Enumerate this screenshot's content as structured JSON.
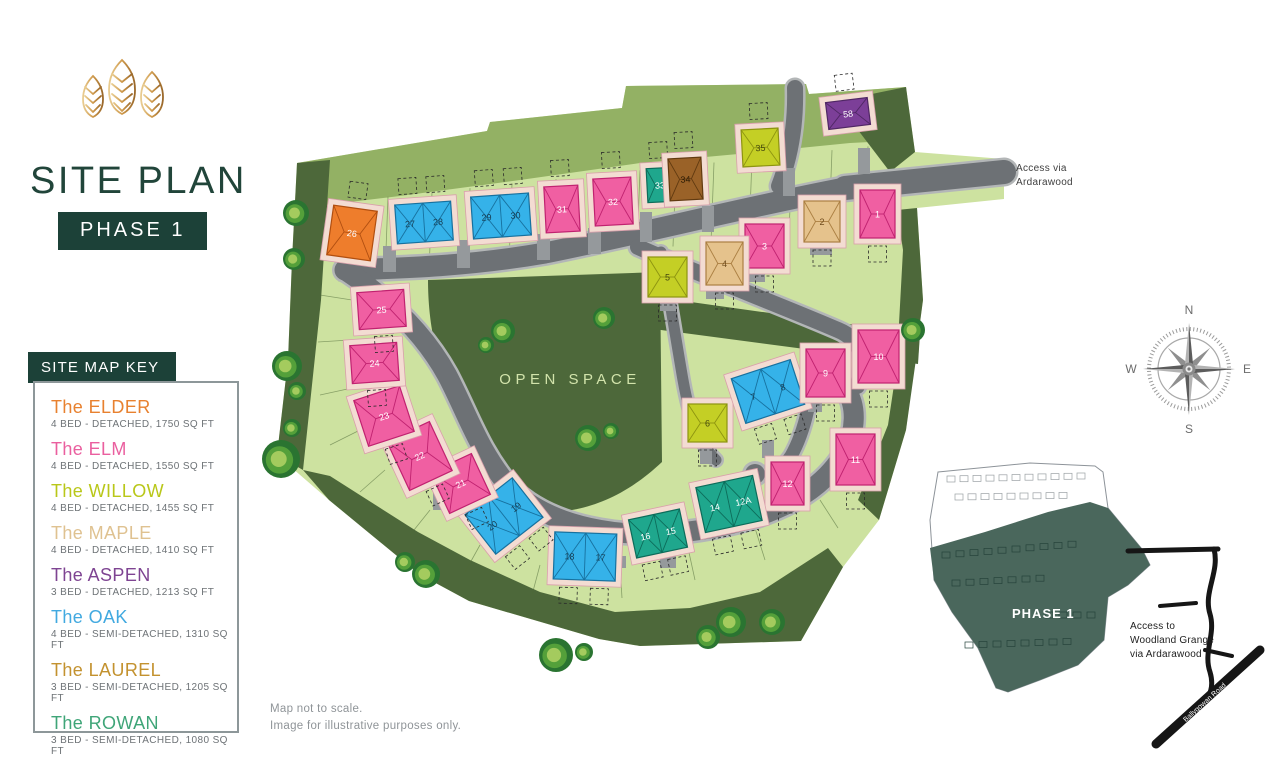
{
  "branding": {
    "title": "SITE PLAN",
    "phase_badge": "PHASE 1"
  },
  "key": {
    "header": "SITE MAP KEY",
    "entries": [
      {
        "name": "The ELDER",
        "desc": "4 BED - DETACHED, 1750 SQ FT",
        "color": "#e8812f",
        "type": "elder"
      },
      {
        "name": "The ELM",
        "desc": "4 BED - DETACHED, 1550 SQ FT",
        "color": "#ea5f9f",
        "type": "elm"
      },
      {
        "name": "The WILLOW",
        "desc": "4 BED - DETACHED, 1455 SQ FT",
        "color": "#b9c719",
        "type": "willow"
      },
      {
        "name": "The MAPLE",
        "desc": "4 BED - DETACHED, 1410 SQ FT",
        "color": "#dfc291",
        "type": "maple"
      },
      {
        "name": "The ASPEN",
        "desc": "3 BED - DETACHED, 1213 SQ FT",
        "color": "#7e4492",
        "type": "aspen"
      },
      {
        "name": "The OAK",
        "desc": "4 BED - SEMI-DETACHED, 1310 SQ FT",
        "color": "#41a9e0",
        "type": "oak"
      },
      {
        "name": "The LAUREL",
        "desc": "3 BED - SEMI-DETACHED, 1205 SQ FT",
        "color": "#c3922f",
        "type": "laurel"
      },
      {
        "name": "The ROWAN",
        "desc": "3 BED - SEMI-DETACHED, 1080 SQ FT",
        "color": "#3fa578",
        "type": "rowan"
      }
    ]
  },
  "map": {
    "open_space_label": "OPEN SPACE",
    "access_label_lines": [
      "Access via",
      "Ardarawood"
    ],
    "house_colors": {
      "elder": {
        "f": "#ee7d2c",
        "s": "#b14f10",
        "n": "#ffffff"
      },
      "elm": {
        "f": "#f05fa2",
        "s": "#c02270",
        "n": "#ffffff"
      },
      "willow": {
        "f": "#c4cf25",
        "s": "#8d9410",
        "n": "#45490e"
      },
      "maple": {
        "f": "#e5c28c",
        "s": "#ab7f42",
        "n": "#6f4c1d"
      },
      "aspen": {
        "f": "#7c3f98",
        "s": "#502765",
        "n": "#ffffff"
      },
      "oak": {
        "f": "#35b2e9",
        "s": "#17719f",
        "n": "#173d52"
      },
      "laurel": {
        "f": "#9a6228",
        "s": "#613a10",
        "n": "#2e1d05"
      },
      "rowan": {
        "f": "#1fa78d",
        "s": "#0d6c5a",
        "n": "#ffffff"
      }
    },
    "plots": [
      {
        "labels": [
          "26"
        ],
        "type": "elder",
        "x": 330,
        "y": 208,
        "w": 44,
        "h": 50,
        "rot": 8,
        "g": "a"
      },
      {
        "labels": [
          "27",
          "28"
        ],
        "type": "oak",
        "x": 396,
        "y": 203,
        "w": 56,
        "h": 39,
        "rot": -4,
        "g": "a"
      },
      {
        "labels": [
          "29",
          "30"
        ],
        "type": "oak",
        "x": 472,
        "y": 195,
        "w": 58,
        "h": 42,
        "rot": -4,
        "g": "a"
      },
      {
        "labels": [
          "31"
        ],
        "type": "elm",
        "x": 545,
        "y": 186,
        "w": 34,
        "h": 46,
        "rot": -3,
        "g": "a"
      },
      {
        "labels": [
          "32"
        ],
        "type": "elm",
        "x": 594,
        "y": 178,
        "w": 38,
        "h": 47,
        "rot": -3,
        "g": "a"
      },
      {
        "labels": [
          "33"
        ],
        "type": "rowan",
        "x": 647,
        "y": 168,
        "w": 26,
        "h": 34,
        "rot": -3,
        "g": "a"
      },
      {
        "labels": [
          "34"
        ],
        "type": "laurel",
        "x": 669,
        "y": 158,
        "w": 33,
        "h": 42,
        "rot": -3,
        "g": "a"
      },
      {
        "labels": [
          "35"
        ],
        "type": "willow",
        "x": 742,
        "y": 129,
        "w": 37,
        "h": 37,
        "rot": -3,
        "g": "a"
      },
      {
        "labels": [
          "58"
        ],
        "type": "aspen",
        "x": 827,
        "y": 100,
        "w": 42,
        "h": 27,
        "rot": -7,
        "g": "a"
      },
      {
        "labels": [
          "1"
        ],
        "type": "elm",
        "x": 860,
        "y": 190,
        "w": 35,
        "h": 48,
        "rot": 0,
        "g": "b"
      },
      {
        "labels": [
          "2"
        ],
        "type": "maple",
        "x": 804,
        "y": 201,
        "w": 36,
        "h": 41,
        "rot": 0,
        "g": "b"
      },
      {
        "labels": [
          "3"
        ],
        "type": "elm",
        "x": 745,
        "y": 224,
        "w": 39,
        "h": 44,
        "rot": 0,
        "g": "b"
      },
      {
        "labels": [
          "4"
        ],
        "type": "maple",
        "x": 706,
        "y": 242,
        "w": 37,
        "h": 43,
        "rot": 0,
        "g": "b"
      },
      {
        "labels": [
          "5"
        ],
        "type": "willow",
        "x": 648,
        "y": 257,
        "w": 39,
        "h": 40,
        "rot": 0,
        "g": "b"
      },
      {
        "labels": [
          "6"
        ],
        "type": "willow",
        "x": 688,
        "y": 404,
        "w": 39,
        "h": 38,
        "rot": 0,
        "g": "b"
      },
      {
        "labels": [
          "7",
          "8"
        ],
        "type": "oak",
        "x": 737,
        "y": 368,
        "w": 62,
        "h": 47,
        "rot": -18,
        "g": "b"
      },
      {
        "labels": [
          "9"
        ],
        "type": "elm",
        "x": 806,
        "y": 349,
        "w": 39,
        "h": 48,
        "rot": 0,
        "g": "b"
      },
      {
        "labels": [
          "10"
        ],
        "type": "elm",
        "x": 858,
        "y": 330,
        "w": 41,
        "h": 53,
        "rot": 0,
        "g": "b"
      },
      {
        "labels": [
          "11"
        ],
        "type": "elm",
        "x": 836,
        "y": 434,
        "w": 39,
        "h": 51,
        "rot": 0,
        "g": "b"
      },
      {
        "labels": [
          "12"
        ],
        "type": "elm",
        "x": 771,
        "y": 462,
        "w": 33,
        "h": 43,
        "rot": 0,
        "g": "b"
      },
      {
        "labels": [
          "14",
          "12A"
        ],
        "type": "rowan",
        "x": 700,
        "y": 481,
        "w": 58,
        "h": 46,
        "rot": -12,
        "g": "b"
      },
      {
        "labels": [
          "16",
          "15"
        ],
        "type": "rowan",
        "x": 632,
        "y": 514,
        "w": 52,
        "h": 39,
        "rot": -12,
        "g": "b"
      },
      {
        "labels": [
          "18",
          "17"
        ],
        "type": "oak",
        "x": 554,
        "y": 533,
        "w": 62,
        "h": 47,
        "rot": 2,
        "g": "b"
      },
      {
        "labels": [
          "20",
          "19"
        ],
        "type": "oak",
        "x": 474,
        "y": 491,
        "w": 60,
        "h": 50,
        "rot": -38,
        "g": "b"
      },
      {
        "labels": [
          "21"
        ],
        "type": "elm",
        "x": 438,
        "y": 461,
        "w": 45,
        "h": 45,
        "rot": -25,
        "g": "b"
      },
      {
        "labels": [
          "22"
        ],
        "type": "elm",
        "x": 396,
        "y": 429,
        "w": 47,
        "h": 54,
        "rot": -25,
        "g": "b"
      },
      {
        "labels": [
          "23"
        ],
        "type": "elm",
        "x": 360,
        "y": 392,
        "w": 48,
        "h": 48,
        "rot": -18,
        "g": "b"
      },
      {
        "labels": [
          "24"
        ],
        "type": "elm",
        "x": 351,
        "y": 344,
        "w": 47,
        "h": 38,
        "rot": -4,
        "g": "b"
      },
      {
        "labels": [
          "25"
        ],
        "type": "elm",
        "x": 358,
        "y": 291,
        "w": 47,
        "h": 37,
        "rot": -4,
        "g": "b"
      }
    ],
    "trees": [
      [
        296,
        213,
        13
      ],
      [
        294,
        259,
        11
      ],
      [
        287,
        366,
        15
      ],
      [
        297,
        391,
        9
      ],
      [
        292,
        428,
        9
      ],
      [
        281,
        459,
        19
      ],
      [
        503,
        331,
        12
      ],
      [
        486,
        345,
        8
      ],
      [
        604,
        318,
        11
      ],
      [
        588,
        438,
        13
      ],
      [
        611,
        431,
        8
      ],
      [
        913,
        330,
        12
      ],
      [
        405,
        562,
        10
      ],
      [
        426,
        574,
        14
      ],
      [
        556,
        655,
        17
      ],
      [
        584,
        652,
        9
      ],
      [
        708,
        637,
        12
      ],
      [
        731,
        622,
        15
      ],
      [
        772,
        622,
        13
      ]
    ]
  },
  "compass": {
    "n": "N",
    "e": "E",
    "s": "S",
    "w": "W"
  },
  "inset": {
    "phase_label": "PHASE 1",
    "access_note_lines": [
      "Access to",
      "Woodland Grange",
      "via Ardarawood"
    ],
    "road_label": "Ballygowan Road"
  },
  "footnotes": [
    "Map not to scale.",
    "Image for illustrative purposes only."
  ]
}
